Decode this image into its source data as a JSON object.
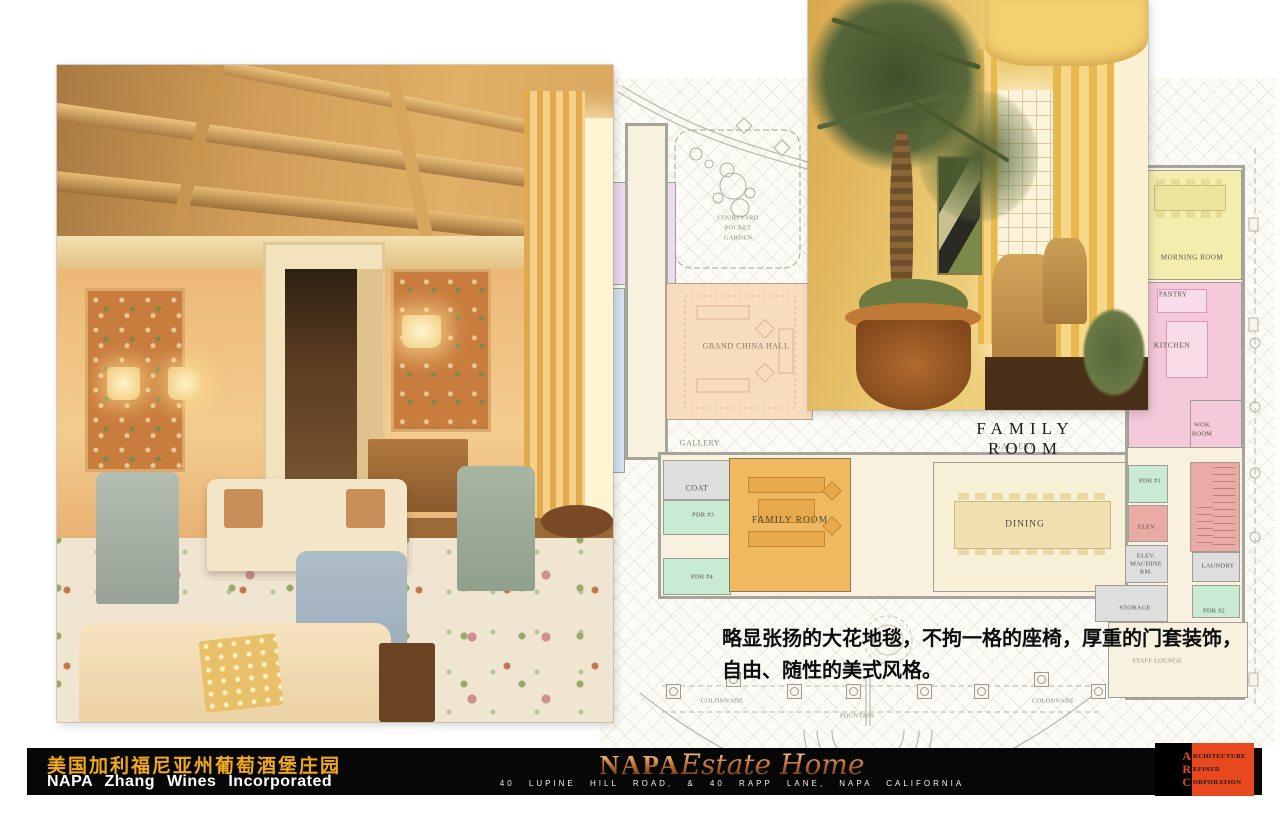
{
  "plan": {
    "title": "FAMILY ROOM",
    "rooms": {
      "courtyard": [
        "COURTYARD",
        "POCKET",
        "GARDEN"
      ],
      "grand_china_hall": "GRAND CHINA HALL",
      "gallery_left": "GALLERY",
      "gallery_right": "GALLERY",
      "coat": "COAT",
      "pdr3": "PDR #3",
      "pdr4": "PDR #4",
      "family_room": "FAMILY ROOM",
      "dining": "DINING",
      "morning_room": "MORNING ROOM",
      "pantry": "PANTRY",
      "kitchen": "KITCHEN",
      "wok_room": [
        "WOK",
        "ROOM"
      ],
      "pdr1": "PDR #1",
      "elev": "ELEV.",
      "elev_machine": [
        "ELEV.",
        "MACHINE",
        "RM."
      ],
      "laundry": "LAUNDRY",
      "storage": "STORAGE",
      "pdr2": "PDR #2",
      "staff_lounge": "STAFF LOUNGE",
      "colonnade_left": "COLONNADE",
      "colonnade_right": "COLONNADE",
      "fountain": "FOUNTAIN"
    },
    "room_colors": {
      "family_room": "#f0b95f",
      "grand_china_hall": "#f8dcc0",
      "dining": "#f8efd7",
      "morning_room": "#f3edae",
      "kitchen_pantry_wok": "#f5c8da",
      "powder_rooms": "#c9ebd3",
      "service_rooms": "#dedede",
      "stairs_elevator": "#e9aba3",
      "lavender_room": "#eedaf0",
      "terrace": "#d4e3f2"
    }
  },
  "caption": {
    "line1": "略显张扬的大花地毯，不拘一格的座椅，厚重的门套装饰，",
    "line2": "自由、随性的美式风格。"
  },
  "footer": {
    "cn_title": "美国加利福尼亚州葡萄酒堡庄园",
    "company": "NAPA Zhang Wines Incorporated",
    "brand_serif": "NAPA",
    "brand_script": "Estate Home",
    "address": "40 LUPINE HILL ROAD, & 40 RAPP LANE, NAPA CALIFORNIA",
    "gold_color": "#f0a81c",
    "brand_copper_color": "#b5672a",
    "arc_orange_color": "#e8481e",
    "arc_letters": [
      "A",
      "R",
      "C"
    ],
    "arc_words": [
      "RCHITECTURE",
      "EFINED",
      "ORPORATION"
    ]
  }
}
